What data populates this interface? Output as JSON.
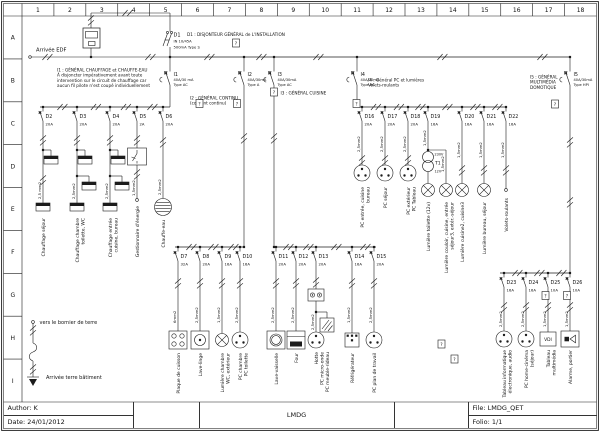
{
  "frame": {
    "columns": [
      "1",
      "2",
      "3",
      "4",
      "5",
      "6",
      "7",
      "8",
      "9",
      "10",
      "11",
      "12",
      "13",
      "14",
      "15",
      "16",
      "17",
      "18"
    ],
    "rows": [
      "A",
      "B",
      "C",
      "D",
      "E",
      "F",
      "G",
      "H",
      "I"
    ]
  },
  "title_block": {
    "author": "Author: K",
    "date": "Date: 24/01/2012",
    "project": "LMDG",
    "file": "File: LMDG_QET",
    "folio": "Folio: 1/1"
  },
  "supply": {
    "label": "Arrivée EDF"
  },
  "earth": {
    "top": "vers le bornier de terre",
    "bottom": "Arrivée terre bâtiment"
  },
  "main_breaker": {
    "id": "D1",
    "rating": "IN 10/45A",
    "diff": "500mA Type S",
    "note": "D1 : DISJONTEUR GÉNÉRAL de L'INSTALLATION"
  },
  "placeholder_glyph": "?",
  "transformer": {
    "id": "T1",
    "primary": "230V",
    "secondary": "12V"
  },
  "rcds": [
    {
      "id": "I1",
      "rating": "40A/30 mA",
      "type": "Type AC",
      "note": [
        "I1 : GÉNÉRAL CHAUFFAGE et CHAUFFE-EAU",
        "À disjoncter impérativement avant toute",
        "intervention sur le circuit de chauffage car",
        "aucun fil pilote n'est coupé individuellement"
      ]
    },
    {
      "id": "I2",
      "rating": "40A/30mA",
      "type": "Type A",
      "note": [
        "I2 : GÉNÉRAL CONTINU",
        "(courant continu)"
      ]
    },
    {
      "id": "I3",
      "rating": "40A/30mA",
      "type": "Type AC",
      "note": [
        "I3 : GÉNÉRAL CUISINE"
      ]
    },
    {
      "id": "I4",
      "rating": "40A/30mA",
      "type": "Type AC",
      "note": [
        "I4 : Général PC et lumières",
        "Volets-roulants"
      ]
    },
    {
      "id": "I5",
      "rating": "40A/30mA",
      "type": "Type HPI",
      "note": [
        "I5 : GÉNÉRAL",
        "MULTIMÉDIA",
        "DOMOTIQUE"
      ]
    }
  ],
  "groups": [
    {
      "circuits": [
        {
          "id": "D2",
          "rating": "20A",
          "wire": "2,5 mm2",
          "load": "heater2",
          "label": [
            "Chauffage séjour"
          ]
        },
        {
          "id": "D3",
          "rating": "20A",
          "wire": "2,5mm2",
          "load": "heater3",
          "label": [
            "Chauffage chambre",
            "toilette, WC"
          ]
        },
        {
          "id": "D4",
          "rating": "20A",
          "wire": "2,5mm2",
          "load": "heater3",
          "label": [
            "Chauffage entrée",
            "cuisine, bureau"
          ]
        },
        {
          "id": "D5",
          "rating": "2A",
          "wire": "1,5mm2",
          "load": "contactor",
          "label": [
            "Gestionnaire d'énergie"
          ]
        },
        {
          "id": "D6",
          "rating": "20A",
          "wire": "2,5mm2",
          "load": "waterheater",
          "label": [
            "Chauffe-eau"
          ]
        }
      ]
    },
    {
      "circuits": [
        {
          "id": "D7",
          "rating": "32A",
          "wire": "6mm2",
          "load": "cooktop",
          "label": [
            "Plaque de cuisson"
          ]
        },
        {
          "id": "D8",
          "rating": "20A",
          "wire": "2,5mm2",
          "load": "washer",
          "label": [
            "Lave-linge"
          ]
        },
        {
          "id": "D9",
          "rating": "16A",
          "wire": "1,5mm2",
          "load": "lamp",
          "label": [
            "Lumière chambre",
            "WC, extérieur"
          ]
        },
        {
          "id": "D10",
          "rating": "16A",
          "wire": "2,5mm2",
          "load": "socket",
          "label": [
            "PC chambre",
            "PC toilette"
          ]
        }
      ]
    },
    {
      "circuits": [
        {
          "id": "D11",
          "rating": "20A",
          "wire": "2,5mm2",
          "load": "dishwasher",
          "label": [
            "Lave-vaisselle"
          ]
        },
        {
          "id": "D12",
          "rating": "20A",
          "wire": "2,5mm2",
          "load": "oven",
          "label": [
            "Four"
          ]
        },
        {
          "id": "D13",
          "rating": "20A",
          "wire": "2,5mm2",
          "load": "hood",
          "label": [
            "Hotte",
            "PC micro-onde",
            "PC meuble-rideau"
          ]
        },
        {
          "id": "D14",
          "rating": "16A",
          "wire": "1,5mm2",
          "load": "fridge",
          "label": [
            "Réfrigérateur"
          ]
        },
        {
          "id": "D15",
          "rating": "20A",
          "wire": "2,5mm2",
          "load": "socket",
          "label": [
            "PC plan de travail"
          ]
        }
      ]
    },
    {
      "circuits": [
        {
          "id": "D16",
          "rating": "20A",
          "wire": "2,5mm2",
          "load": "socket",
          "label": [
            "PC entrée, cuisine",
            "bureau"
          ]
        },
        {
          "id": "D17",
          "rating": "20A",
          "wire": "2,5mm2",
          "load": "socket",
          "label": [
            "PC séjour"
          ]
        },
        {
          "id": "D18",
          "rating": "20A",
          "wire": "2,5mm2",
          "load": "socket",
          "label": [
            "PC extérieur",
            "PC Tableau"
          ]
        },
        {
          "id": "D19",
          "rating": "16A",
          "wire": "1,5mm2",
          "wire2": "1,5mm2",
          "load": "transformer_lamps",
          "label": [
            "Lumière toilette (12v)"
          ],
          "label2": [
            "Lumière couloir, cuisine, entrée",
            "séjour3, extér.-séjour"
          ]
        },
        {
          "id": "D20",
          "rating": "16A",
          "wire": "1,5mm2",
          "load": "lamp",
          "label": [
            "Lumière cuisine2, cuisine3"
          ]
        },
        {
          "id": "D21",
          "rating": "16A",
          "wire": "1,5mm2",
          "load": "lamp",
          "label": [
            "Lumière bureau, séjour"
          ]
        },
        {
          "id": "D22",
          "rating": "16A",
          "wire": "1,5mm2",
          "load": "terminal",
          "label": [
            "Volets-roulants"
          ]
        }
      ]
    },
    {
      "circuits": [
        {
          "id": "D23",
          "rating": "16A",
          "wire": "2,5mm2",
          "load": "socket",
          "label": [
            "Tableau informatique",
            "électronique, audio"
          ]
        },
        {
          "id": "D24",
          "rating": "16A",
          "wire": "2,5mm2",
          "load": "socket",
          "label": [
            "PC home-cinéma",
            "(séjour)"
          ]
        },
        {
          "id": "D25",
          "rating": "10A",
          "wire": "1,5mm2",
          "load": "vdi",
          "load_text": "VDI",
          "label": [
            "Tableau",
            "multimédia"
          ]
        },
        {
          "id": "D26",
          "rating": "10A",
          "wire": "1,5mm2",
          "load": "doorbell",
          "label": [
            "Alarme, portier"
          ]
        }
      ]
    }
  ]
}
